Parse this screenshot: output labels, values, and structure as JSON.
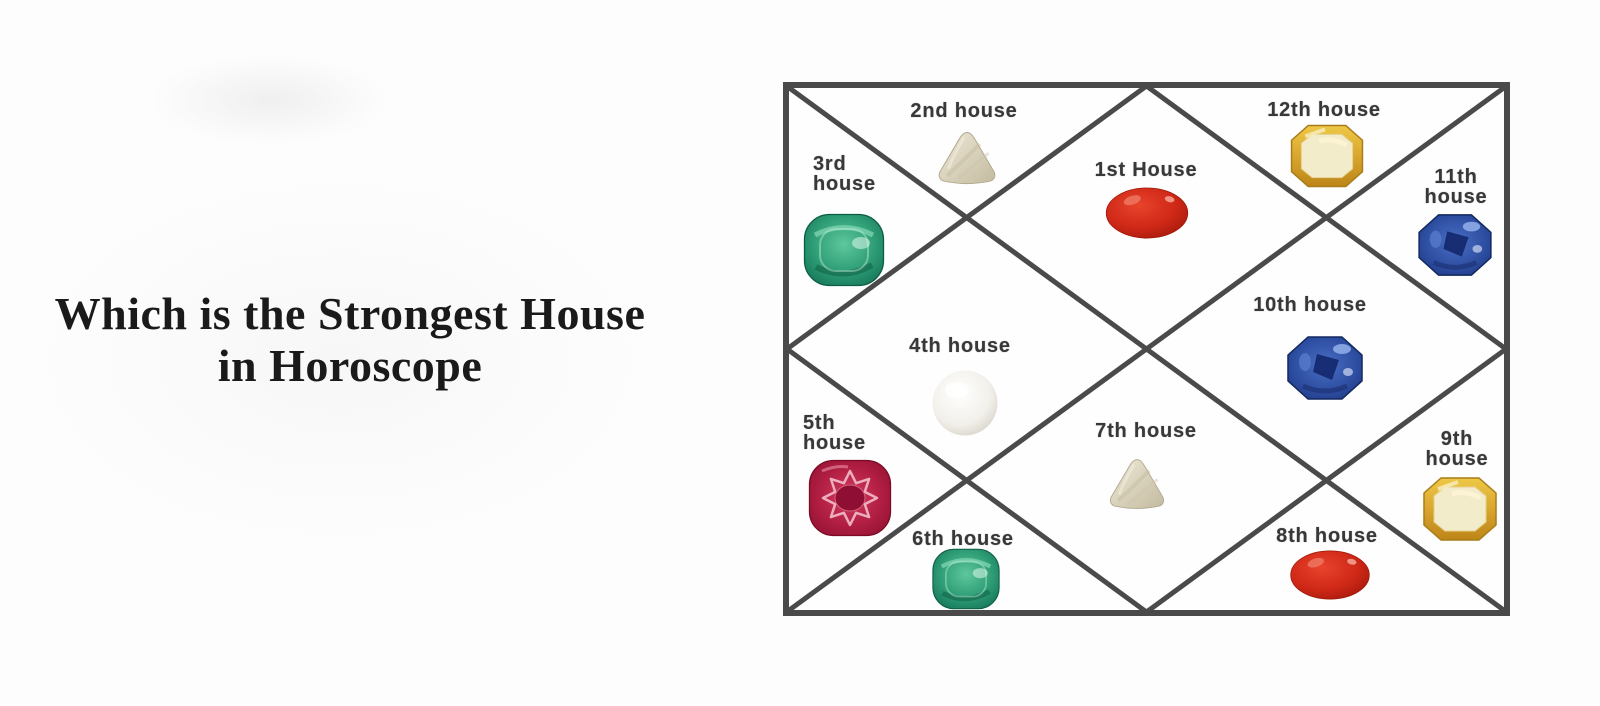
{
  "title": {
    "line1": "Which is the Strongest House",
    "line2": "in Horoscope"
  },
  "chart": {
    "houses": [
      {
        "label": "1st House",
        "gem": "red-coral"
      },
      {
        "label": "2nd house",
        "gem": "white-trillion-stone"
      },
      {
        "label": "3rd house",
        "gem": "emerald"
      },
      {
        "label": "4th house",
        "gem": "pearl"
      },
      {
        "label": "5th house",
        "gem": "ruby"
      },
      {
        "label": "6th house",
        "gem": "emerald"
      },
      {
        "label": "7th house",
        "gem": "white-trillion-stone"
      },
      {
        "label": "8th house",
        "gem": "red-coral"
      },
      {
        "label": "9th house",
        "gem": "yellow-sapphire"
      },
      {
        "label": "10th house",
        "gem": "blue-sapphire"
      },
      {
        "label": "11th house",
        "gem": "blue-sapphire"
      },
      {
        "label": "12th house",
        "gem": "yellow-sapphire"
      }
    ],
    "colors": {
      "frame": "#4a4a4a",
      "label_text": "#383838",
      "red_coral": "#cf2817",
      "emerald": "#2f9e76",
      "ruby": "#b01e42",
      "blue_sapphire": "#2c4c9f",
      "yellow_sapphire": "#d9a62e",
      "pearl": "#f2f0ea",
      "trillion_stone": "#d9d2bc"
    }
  }
}
